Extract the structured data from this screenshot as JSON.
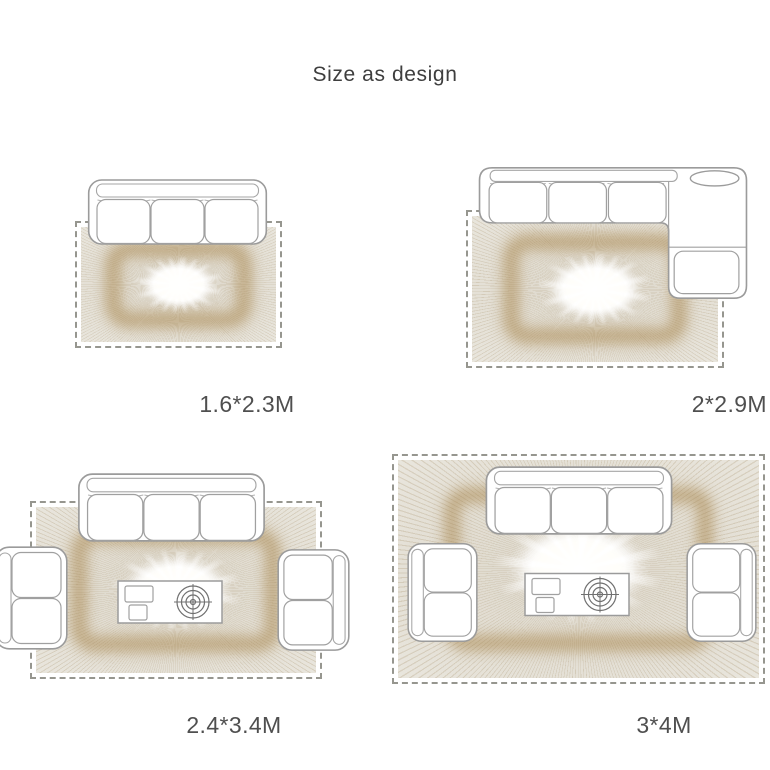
{
  "title": "Size as design",
  "colors": {
    "label_text": "#4f4f4f",
    "outline_gray": "#9b9b9b",
    "rug_base_beige": "#e5e1d7",
    "rug_gold_accent": "#a37f41",
    "rug_center_white": "#ffffff",
    "dashed_border": "#96968f"
  },
  "diagrams": [
    {
      "label": "1.6*2.3M",
      "furniture": [
        "three-seat-sofa"
      ]
    },
    {
      "label": "2*2.9M",
      "furniture": [
        "sectional-sofa-with-chaise"
      ]
    },
    {
      "label": "2.4*3.4M",
      "furniture": [
        "three-seat-sofa",
        "loveseat-left",
        "loveseat-right",
        "coffee-table"
      ]
    },
    {
      "label": "3*4M",
      "furniture": [
        "three-seat-sofa",
        "loveseat-left",
        "loveseat-right",
        "coffee-table"
      ]
    }
  ]
}
